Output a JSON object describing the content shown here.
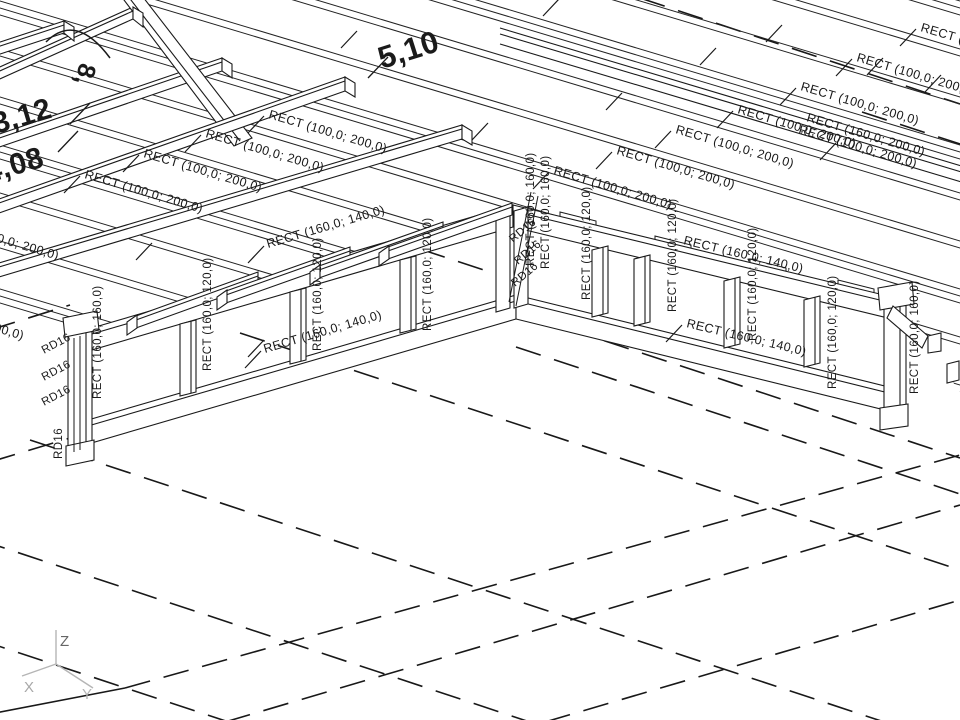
{
  "scene": {
    "view_title": "3D structural wireframe view (timber frame with joists, posts and tie rods)",
    "background": "#ffffff",
    "line_color": "#1a1a1a",
    "axis_color": "#b5b5b5",
    "axis_label_color": "#a0a0a0",
    "axis": {
      "x": "X",
      "y": "Y",
      "z": "Z"
    },
    "member_types": {
      "joist": "RECT (100,0; 200,0)",
      "edge_joist": "RECT (160,0; 200,0)",
      "rail": "RECT (160,0; 140,0)",
      "post": "RECT (160,0; 120,0)",
      "corner_post": "RECT (160,0; 160,0)",
      "tie_rod": "RD16"
    },
    "dimensions": [
      "3,12",
      "4,08",
      "5,10",
      "8,"
    ],
    "roof": {
      "count": 13,
      "y_start": -287,
      "spacing": 48,
      "slope": 0.3,
      "pair_gap": 7,
      "x1": -40,
      "x2": 1010
    },
    "ticks": [
      [
        543,
        16
      ],
      [
        341,
        48
      ],
      [
        766,
        42
      ],
      [
        925,
        92
      ],
      [
        606,
        110
      ],
      [
        867,
        75
      ],
      [
        193,
        310
      ],
      [
        136,
        260
      ],
      [
        248,
        357
      ],
      [
        472,
        140
      ],
      [
        700,
        65
      ],
      [
        820,
        160
      ]
    ],
    "labels": [
      {
        "t": "RECT (100,0; 200,0)",
        "x": -60,
        "y": 225,
        "r": 16.5,
        "lead": false
      },
      {
        "t": "RECT (100,0; 200,0)",
        "x": -95,
        "y": 305,
        "r": 16.5,
        "lead": false
      },
      {
        "t": "RECT (100,0; 200,0)",
        "x": 84,
        "y": 178,
        "r": 16.5,
        "lead": true
      },
      {
        "t": "RECT (100,0; 200,0)",
        "x": 143,
        "y": 157,
        "r": 16.5,
        "lead": true
      },
      {
        "t": "RECT (100,0; 200,0)",
        "x": 205,
        "y": 137,
        "r": 16.5,
        "lead": true
      },
      {
        "t": "RECT (100,0; 200,0)",
        "x": 268,
        "y": 118,
        "r": 16.5,
        "lead": true
      },
      {
        "t": "RECT (100,0; 200,0)",
        "x": 553,
        "y": 174,
        "r": 16.5,
        "lead": true
      },
      {
        "t": "RECT (100,0; 200,0)",
        "x": 616,
        "y": 154,
        "r": 16.5,
        "lead": true
      },
      {
        "t": "RECT (100,0; 200,0)",
        "x": 675,
        "y": 133,
        "r": 16.5,
        "lead": true
      },
      {
        "t": "RECT (100,0; 200,0)",
        "x": 737,
        "y": 113,
        "r": 16.5,
        "lead": true
      },
      {
        "t": "RECT (100,0; 200,0)",
        "x": 800,
        "y": 90,
        "r": 16.5,
        "lead": true
      },
      {
        "t": "RECT (100,0; 200,0)",
        "x": 856,
        "y": 61,
        "r": 16.5,
        "lead": true
      },
      {
        "t": "RECT (100,0; 200,0)",
        "x": 920,
        "y": 31,
        "r": 16.5,
        "lead": true
      },
      {
        "t": "RECT (100,0; 200,0)",
        "x": 798,
        "y": 133,
        "r": 16.5,
        "lead": false
      },
      {
        "t": "RECT (160,0; 200,0)",
        "x": 806,
        "y": 121,
        "r": 16.5,
        "lead": false
      },
      {
        "t": "RECT (160,0; 140,0)",
        "x": 265,
        "y": 353,
        "r": -16.5,
        "lead": true
      },
      {
        "t": "RECT (160,0; 140,0)",
        "x": 268,
        "y": 248,
        "r": -16.5,
        "lead": true
      },
      {
        "t": "RECT (160,0; 140,0)",
        "x": 683,
        "y": 244,
        "r": 13.5,
        "lead": false
      },
      {
        "t": "RECT (160,0; 140,0)",
        "x": 686,
        "y": 327,
        "r": 13.5,
        "lead": true
      },
      {
        "t": "RECT (160,0; 160,0)",
        "x": 101,
        "y": 399,
        "r": -90,
        "s": 11.5
      },
      {
        "t": "RECT (160,0; 120,0)",
        "x": 211,
        "y": 371,
        "r": -90,
        "s": 11.5
      },
      {
        "t": "RECT (160,0; 120,0)",
        "x": 321,
        "y": 351,
        "r": -90,
        "s": 11.5
      },
      {
        "t": "RECT (160,0; 120,0)",
        "x": 431,
        "y": 331,
        "r": -90,
        "s": 11.5
      },
      {
        "t": "RECT (160,0; 160,0)",
        "x": 534,
        "y": 266,
        "r": -90,
        "s": 11.5
      },
      {
        "t": "RECT (160,0; 160,0)",
        "x": 549,
        "y": 269,
        "r": -90,
        "s": 11.5
      },
      {
        "t": "RECT (160,0; 120,0)",
        "x": 590,
        "y": 300,
        "r": -90,
        "s": 11.5
      },
      {
        "t": "RECT (160,0; 120,0)",
        "x": 676,
        "y": 312,
        "r": -90,
        "s": 11.5
      },
      {
        "t": "RECT (160,0; 120,0)",
        "x": 756,
        "y": 341,
        "r": -90,
        "s": 11.5
      },
      {
        "t": "RECT (160,0; 120,0)",
        "x": 836,
        "y": 389,
        "r": -90,
        "s": 11.5
      },
      {
        "t": "RECT (160,0; 160,0)",
        "x": 918,
        "y": 394,
        "r": -90,
        "s": 11.5
      },
      {
        "t": "RD16",
        "x": 44,
        "y": 354,
        "r": -28,
        "s": 11.5
      },
      {
        "t": "RD16",
        "x": 44,
        "y": 381,
        "r": -28,
        "s": 11.5
      },
      {
        "t": "RD16",
        "x": 44,
        "y": 406,
        "r": -28,
        "s": 11.5
      },
      {
        "t": "RD16",
        "x": 62,
        "y": 459,
        "r": -90,
        "s": 11.5
      },
      {
        "t": "RD16",
        "x": 513,
        "y": 243,
        "r": -40,
        "s": 11.5
      },
      {
        "t": "RD16",
        "x": 518,
        "y": 265,
        "r": -40,
        "s": 11.5
      },
      {
        "t": "RD16",
        "x": 515,
        "y": 287,
        "r": -40,
        "s": 11.5
      },
      {
        "t": "3,12",
        "x": -4,
        "y": 134,
        "r": -16.5,
        "s": 30,
        "b": true
      },
      {
        "t": "4,08",
        "x": -12,
        "y": 183,
        "r": -16.5,
        "s": 30,
        "b": true
      },
      {
        "t": "5,10",
        "x": 382,
        "y": 69,
        "r": -17.5,
        "s": 31,
        "b": true
      },
      {
        "t": "8,",
        "x": 80,
        "y": 62,
        "r": 105,
        "s": 25,
        "b": true
      }
    ]
  }
}
